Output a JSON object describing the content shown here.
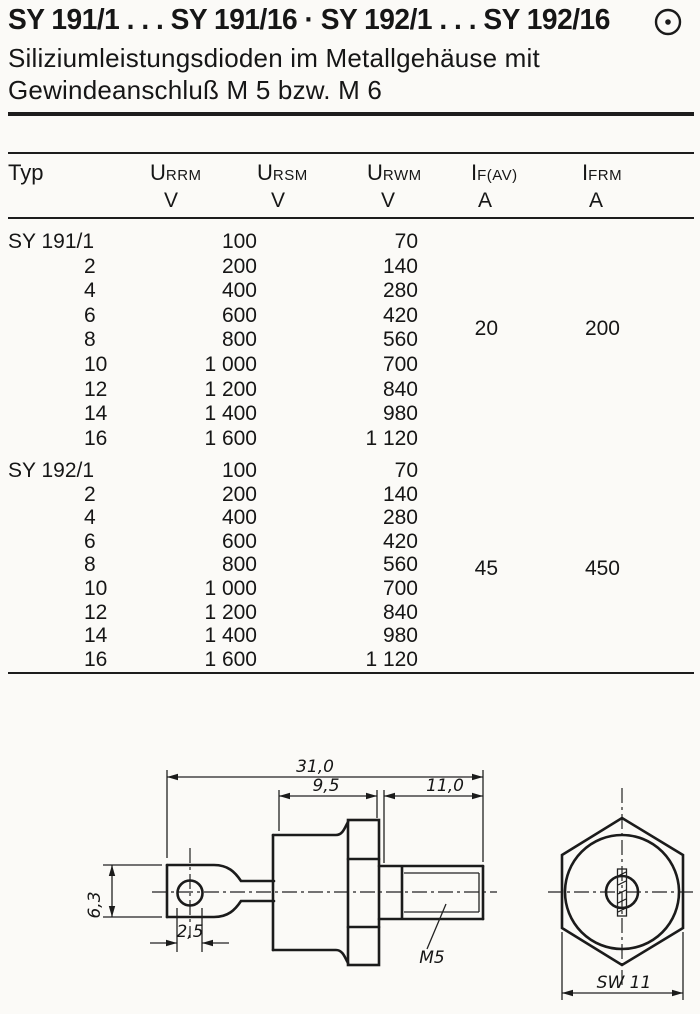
{
  "header": {
    "title": "SY 191/1 . . . SY 191/16 · SY 192/1 . . . SY 192/16",
    "subtitle": [
      "Siliziumleistungsdioden im Metallgehäuse mit",
      "Gewindeanschluß M 5 bzw. M 6"
    ],
    "mark_icon": "circled-dot-icon"
  },
  "table": {
    "col_typ": "Typ",
    "cols": [
      {
        "base": "U",
        "sub": "RRM",
        "unit": "V"
      },
      {
        "base": "U",
        "sub": "RSM",
        "unit": "V"
      },
      {
        "base": "U",
        "sub": "RWM",
        "unit": "V"
      },
      {
        "base": "I",
        "sub": "F(AV)",
        "unit": "A"
      },
      {
        "base": "I",
        "sub": "FRM",
        "unit": "A"
      }
    ],
    "blocks": [
      {
        "series": "SY 191",
        "if_av": "20",
        "ifrm": "200",
        "rows": [
          {
            "typ": "SY 191/1",
            "u": "100",
            "uw": "70"
          },
          {
            "typ": "2",
            "u": "200",
            "uw": "140"
          },
          {
            "typ": "4",
            "u": "400",
            "uw": "280"
          },
          {
            "typ": "6",
            "u": "600",
            "uw": "420"
          },
          {
            "typ": "8",
            "u": "800",
            "uw": "560"
          },
          {
            "typ": "10",
            "u": "1 000",
            "uw": "700"
          },
          {
            "typ": "12",
            "u": "1 200",
            "uw": "840"
          },
          {
            "typ": "14",
            "u": "1 400",
            "uw": "980"
          },
          {
            "typ": "16",
            "u": "1 600",
            "uw": "1 120"
          }
        ]
      },
      {
        "series": "SY 192",
        "if_av": "45",
        "ifrm": "450",
        "rows": [
          {
            "typ": "SY 192/1",
            "u": "100",
            "uw": "70"
          },
          {
            "typ": "2",
            "u": "200",
            "uw": "140"
          },
          {
            "typ": "4",
            "u": "400",
            "uw": "280"
          },
          {
            "typ": "6",
            "u": "600",
            "uw": "420"
          },
          {
            "typ": "8",
            "u": "800",
            "uw": "560"
          },
          {
            "typ": "10",
            "u": "1 000",
            "uw": "700"
          },
          {
            "typ": "12",
            "u": "1 200",
            "uw": "840"
          },
          {
            "typ": "14",
            "u": "1 400",
            "uw": "980"
          },
          {
            "typ": "16",
            "u": "1 600",
            "uw": "1 120"
          }
        ]
      }
    ]
  },
  "drawing": {
    "dim_total_length": "31,0",
    "dim_body_length": "9,5",
    "dim_stud_length": "11,0",
    "dim_lug_height": "6,3",
    "dim_hole_diameter": "2,5",
    "thread_label": "M5",
    "wrench_size": "SW 11",
    "ink_color": "#1b1b1b",
    "paper_color": "#fbfaf7"
  }
}
